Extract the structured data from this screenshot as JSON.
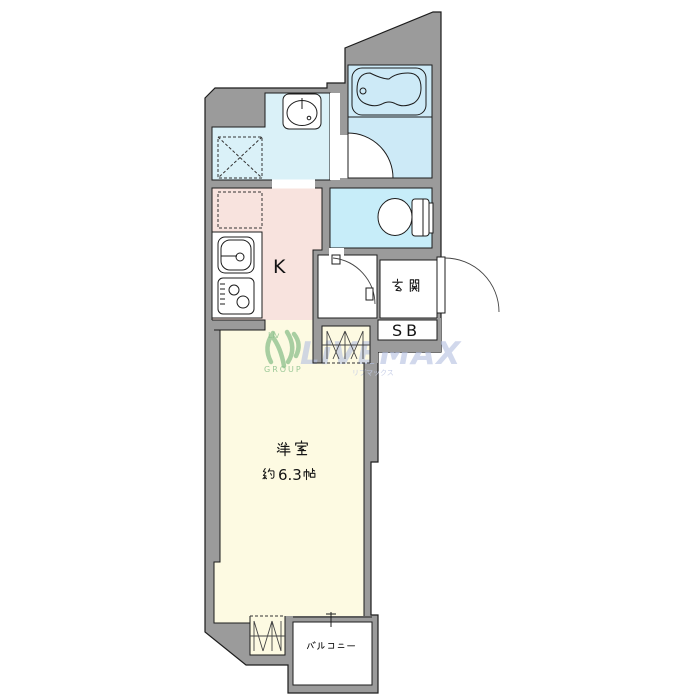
{
  "watermark": {
    "brand": "LiVEMAX",
    "logo_text": "Liv",
    "group_text": "GROUP",
    "subtext": "リブマックス"
  },
  "labels": {
    "kitchen": "K",
    "genkan": "玄関",
    "shoe_box": "SB",
    "main_room_name": "洋室",
    "main_room_size": "約6.3帖",
    "main_room_size_number": "6.3",
    "balcony": "バルコニー"
  },
  "colors": {
    "wall": "#9b9b9b",
    "line": "#1c1c1c",
    "washroom": "#daf1f8",
    "bathroom": "#cdeaf7",
    "toilet": "#c7edf9",
    "kitchen": "#f8e3de",
    "room": "#fdfae2",
    "wm": "#b5c1e1",
    "wmgreen": "#8cc08c"
  }
}
